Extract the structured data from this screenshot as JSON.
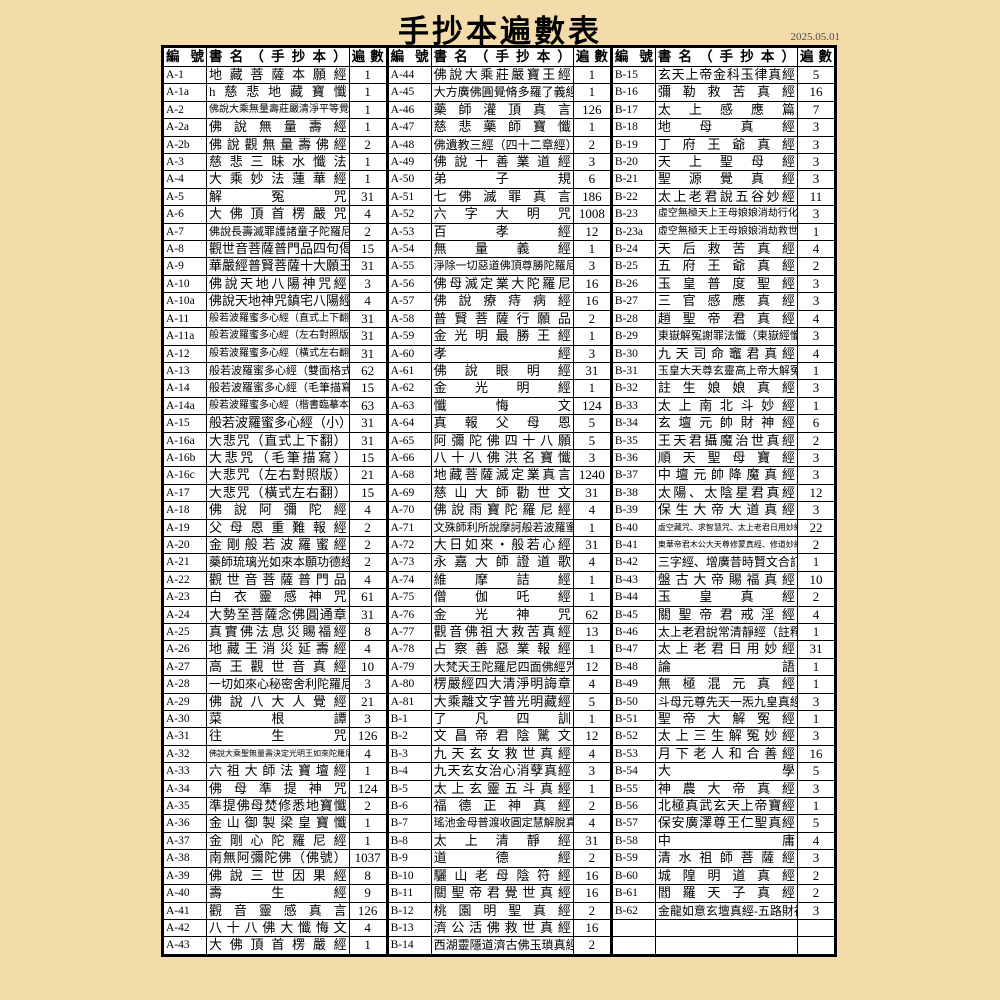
{
  "page": {
    "title": "手抄本遍數表",
    "date": "2025.05.01",
    "bg_color": "#f3dcaa",
    "table_bg_color": "#ffffff",
    "border_color": "#000000"
  },
  "table": {
    "header": {
      "id": "編號",
      "name": "書名（手抄本）",
      "count": "遍數"
    },
    "columns": [
      {
        "rows": [
          {
            "id": "A-1",
            "name": "地藏菩薩本願經",
            "count": "1"
          },
          {
            "id": "A-1a",
            "name": "h慈悲地藏寶懺",
            "count": "1"
          },
          {
            "id": "A-2",
            "name": "佛說大乘無量壽莊嚴清淨平等覺經",
            "count": "1"
          },
          {
            "id": "A-2a",
            "name": "佛說無量壽經",
            "count": "1"
          },
          {
            "id": "A-2b",
            "name": "佛說觀無量壽佛經",
            "count": "2"
          },
          {
            "id": "A-3",
            "name": "慈悲三昧水懺法",
            "count": "1"
          },
          {
            "id": "A-4",
            "name": "大乘妙法蓮華經",
            "count": "1"
          },
          {
            "id": "A-5",
            "name": "解冤咒",
            "count": "31"
          },
          {
            "id": "A-6",
            "name": "大佛頂首楞嚴咒",
            "count": "4"
          },
          {
            "id": "A-7",
            "name": "佛說長壽滅罪護諸童子陀羅尼經",
            "count": "2"
          },
          {
            "id": "A-8",
            "name": "觀世音菩薩普門品四句偈",
            "count": "15"
          },
          {
            "id": "A-9",
            "name": "華嚴經普賢菩薩十大願王",
            "count": "31"
          },
          {
            "id": "A-10",
            "name": "佛說天地八陽神咒經",
            "count": "3"
          },
          {
            "id": "A-10a",
            "name": "佛說天地神咒鎮宅八陽經",
            "count": "4"
          },
          {
            "id": "A-11",
            "name": "般若波羅蜜多心經（直式上下翻）",
            "count": "31"
          },
          {
            "id": "A-11a",
            "name": "般若波羅蜜多心經（左右對照版）",
            "count": "31"
          },
          {
            "id": "A-12",
            "name": "般若波羅蜜多心經（橫式左右翻）",
            "count": "31"
          },
          {
            "id": "A-13",
            "name": "般若波羅蜜多心經（雙面格式）",
            "count": "62"
          },
          {
            "id": "A-14",
            "name": "般若波羅蜜多心經（毛筆描寫）",
            "count": "15"
          },
          {
            "id": "A-14a",
            "name": "般若波羅蜜多心經（楷書臨摹本）",
            "count": "63"
          },
          {
            "id": "A-15",
            "name": "般若波羅蜜多心經（小）",
            "count": "31"
          },
          {
            "id": "A-16a",
            "name": "大悲咒（直式上下翻）",
            "count": "31"
          },
          {
            "id": "A-16b",
            "name": "大悲咒（毛筆描寫）",
            "count": "15"
          },
          {
            "id": "A-16c",
            "name": "大悲咒（左右對照版）",
            "count": "21"
          },
          {
            "id": "A-17",
            "name": "大悲咒（橫式左右翻）",
            "count": "15"
          },
          {
            "id": "A-18",
            "name": "佛說阿彌陀經",
            "count": "4"
          },
          {
            "id": "A-19",
            "name": "父母恩重難報經",
            "count": "2"
          },
          {
            "id": "A-20",
            "name": "金剛般若波羅蜜經",
            "count": "2"
          },
          {
            "id": "A-21",
            "name": "藥師琉璃光如來本願功德經",
            "count": "2"
          },
          {
            "id": "A-22",
            "name": "觀世音菩薩普門品",
            "count": "4"
          },
          {
            "id": "A-23",
            "name": "白衣靈感神咒",
            "count": "61"
          },
          {
            "id": "A-24",
            "name": "大勢至菩薩念佛圓通章",
            "count": "31"
          },
          {
            "id": "A-25",
            "name": "真實佛法息災賜福經",
            "count": "8"
          },
          {
            "id": "A-26",
            "name": "地藏王消災延壽經",
            "count": "4"
          },
          {
            "id": "A-27",
            "name": "高王觀世音真經",
            "count": "10"
          },
          {
            "id": "A-28",
            "name": "一切如來心秘密舍利陀羅尼經",
            "count": "3"
          },
          {
            "id": "A-29",
            "name": "佛說八大人覺經",
            "count": "21"
          },
          {
            "id": "A-30",
            "name": "菜根譚",
            "count": "3"
          },
          {
            "id": "A-31",
            "name": "往生咒",
            "count": "126"
          },
          {
            "id": "A-32",
            "name": "佛說大乘聖無量壽決定光明王如來陀羅尼經",
            "count": "4"
          },
          {
            "id": "A-33",
            "name": "六祖大師法寶壇經",
            "count": "1"
          },
          {
            "id": "A-34",
            "name": "佛母準提神咒",
            "count": "124"
          },
          {
            "id": "A-35",
            "name": "準提佛母焚修悉地寶懺",
            "count": "2"
          },
          {
            "id": "A-36",
            "name": "金山御製梁皇寶懺",
            "count": "1"
          },
          {
            "id": "A-37",
            "name": "金剛心陀羅尼經",
            "count": "1"
          },
          {
            "id": "A-38",
            "name": "南無阿彌陀佛（佛號）",
            "count": "1037"
          },
          {
            "id": "A-39",
            "name": "佛說三世因果經",
            "count": "8"
          },
          {
            "id": "A-40",
            "name": "壽生經",
            "count": "9"
          },
          {
            "id": "A-41",
            "name": "觀音靈感真言",
            "count": "126"
          },
          {
            "id": "A-42",
            "name": "八十八佛大懺悔文",
            "count": "4"
          },
          {
            "id": "A-43",
            "name": "大佛頂首楞嚴經",
            "count": "1"
          }
        ]
      },
      {
        "rows": [
          {
            "id": "A-44",
            "name": "佛說大乘莊嚴寶王經",
            "count": "1"
          },
          {
            "id": "A-45",
            "name": "大方廣佛圓覺脩多羅了義經",
            "count": "1"
          },
          {
            "id": "A-46",
            "name": "藥師灌頂真言",
            "count": "126"
          },
          {
            "id": "A-47",
            "name": "慈悲藥師寶懺",
            "count": "1"
          },
          {
            "id": "A-48",
            "name": "佛遺教三經（四十二章經）",
            "count": "2"
          },
          {
            "id": "A-49",
            "name": "佛說十善業道經",
            "count": "3"
          },
          {
            "id": "A-50",
            "name": "弟子規",
            "count": "6"
          },
          {
            "id": "A-51",
            "name": "七佛滅罪真言",
            "count": "186"
          },
          {
            "id": "A-52",
            "name": "六字大明咒",
            "count": "1008"
          },
          {
            "id": "A-53",
            "name": "百孝經",
            "count": "12"
          },
          {
            "id": "A-54",
            "name": "無量義經",
            "count": "1"
          },
          {
            "id": "A-55",
            "name": "淨除一切惡道佛頂尊勝陀羅尼經",
            "count": "3"
          },
          {
            "id": "A-56",
            "name": "佛母滅定業大陀羅尼",
            "count": "16"
          },
          {
            "id": "A-57",
            "name": "佛說療痔病經",
            "count": "16"
          },
          {
            "id": "A-58",
            "name": "普賢菩薩行願品",
            "count": "2"
          },
          {
            "id": "A-59",
            "name": "金光明最勝王經",
            "count": "1"
          },
          {
            "id": "A-60",
            "name": "孝經",
            "count": "3"
          },
          {
            "id": "A-61",
            "name": "佛說眼明經",
            "count": "31"
          },
          {
            "id": "A-62",
            "name": "金光明經",
            "count": "1"
          },
          {
            "id": "A-63",
            "name": "懺悔文",
            "count": "124"
          },
          {
            "id": "A-64",
            "name": "真報父母恩",
            "count": "5"
          },
          {
            "id": "A-65",
            "name": "阿彌陀佛四十八願",
            "count": "5"
          },
          {
            "id": "A-66",
            "name": "八十八佛洪名寶懺",
            "count": "3"
          },
          {
            "id": "A-68",
            "name": "地藏菩薩滅定業真言",
            "count": "1240"
          },
          {
            "id": "A-69",
            "name": "慈山大師勸世文",
            "count": "31"
          },
          {
            "id": "A-70",
            "name": "佛說雨寶陀羅尼經",
            "count": "4"
          },
          {
            "id": "A-71",
            "name": "文殊師利所說摩訶般若波羅蜜經",
            "count": "1"
          },
          {
            "id": "A-72",
            "name": "大日如來・般若心經",
            "count": "31"
          },
          {
            "id": "A-73",
            "name": "永嘉大師證道歌",
            "count": "4"
          },
          {
            "id": "A-74",
            "name": "維摩詰經",
            "count": "1"
          },
          {
            "id": "A-75",
            "name": "僧伽吒經",
            "count": "1"
          },
          {
            "id": "A-76",
            "name": "金光神咒",
            "count": "62"
          },
          {
            "id": "A-77",
            "name": "觀音佛祖大救苦真經",
            "count": "13"
          },
          {
            "id": "A-78",
            "name": "占察善惡業報經",
            "count": "1"
          },
          {
            "id": "A-79",
            "name": "大梵天王陀羅尼四面佛經咒",
            "count": "12"
          },
          {
            "id": "A-80",
            "name": "楞嚴經四大清淨明誨章",
            "count": "4"
          },
          {
            "id": "A-81",
            "name": "大乘離文字普光明藏經",
            "count": "5"
          },
          {
            "id": "B-1",
            "name": "了凡四訓",
            "count": "1"
          },
          {
            "id": "B-2",
            "name": "文昌帝君陰騭文",
            "count": "12"
          },
          {
            "id": "B-3",
            "name": "九天玄女救世真經",
            "count": "4"
          },
          {
            "id": "B-4",
            "name": "九天玄女治心消孽真經",
            "count": "3"
          },
          {
            "id": "B-5",
            "name": "太上玄靈五斗真經",
            "count": "1"
          },
          {
            "id": "B-6",
            "name": "福德正神真經",
            "count": "2"
          },
          {
            "id": "B-7",
            "name": "瑤池金母普渡收圓定慧解脫真經",
            "count": "4"
          },
          {
            "id": "B-8",
            "name": "太上清靜經",
            "count": "31"
          },
          {
            "id": "B-9",
            "name": "道德經",
            "count": "2"
          },
          {
            "id": "B-10",
            "name": "驪山老母陰符經",
            "count": "16"
          },
          {
            "id": "B-11",
            "name": "關聖帝君覺世真經",
            "count": "16"
          },
          {
            "id": "B-12",
            "name": "桃園明聖真經",
            "count": "2"
          },
          {
            "id": "B-13",
            "name": "濟公活佛救世真經",
            "count": "16"
          },
          {
            "id": "B-14",
            "name": "西湖靈隱道濟古佛玉瑣真經",
            "count": "2"
          }
        ]
      },
      {
        "rows": [
          {
            "id": "B-15",
            "name": "玄天上帝金科玉律真經",
            "count": "5"
          },
          {
            "id": "B-16",
            "name": "彌勒救苦真經",
            "count": "16"
          },
          {
            "id": "B-17",
            "name": "太上感應篇",
            "count": "7"
          },
          {
            "id": "B-18",
            "name": "地母真經",
            "count": "3"
          },
          {
            "id": "B-19",
            "name": "丁府王爺真經",
            "count": "3"
          },
          {
            "id": "B-20",
            "name": "天上聖母經",
            "count": "3"
          },
          {
            "id": "B-21",
            "name": "聖源覺真經",
            "count": "3"
          },
          {
            "id": "B-22",
            "name": "太上老君說五谷妙經",
            "count": "11"
          },
          {
            "id": "B-23",
            "name": "虛空無極天上王母娘娘消劫行化寶懺",
            "count": "3"
          },
          {
            "id": "B-23a",
            "name": "虛空無極天上王母娘娘消劫救世寶懺",
            "count": "1"
          },
          {
            "id": "B-24",
            "name": "天后救苦真經",
            "count": "4"
          },
          {
            "id": "B-25",
            "name": "五府王爺真經",
            "count": "2"
          },
          {
            "id": "B-26",
            "name": "玉皇普度聖經",
            "count": "3"
          },
          {
            "id": "B-27",
            "name": "三官感應真經",
            "count": "3"
          },
          {
            "id": "B-28",
            "name": "趙聖帝君真經",
            "count": "4"
          },
          {
            "id": "B-29",
            "name": "東嶽解冤謝罪法懺（東嶽經懺）",
            "count": "3"
          },
          {
            "id": "B-30",
            "name": "九天司命竈君真經",
            "count": "4"
          },
          {
            "id": "B-31",
            "name": "玉皇大天尊玄靈高上帝大解冤經",
            "count": "1"
          },
          {
            "id": "B-32",
            "name": "註生娘娘真經",
            "count": "3"
          },
          {
            "id": "B-33",
            "name": "太上南北斗妙經",
            "count": "1"
          },
          {
            "id": "B-34",
            "name": "玄壇元帥財神經",
            "count": "6"
          },
          {
            "id": "B-35",
            "name": "王天君攝魔治世真經",
            "count": "2"
          },
          {
            "id": "B-36",
            "name": "順天聖母寶經",
            "count": "3"
          },
          {
            "id": "B-37",
            "name": "中壇元帥降魔真經",
            "count": "3"
          },
          {
            "id": "B-38",
            "name": "太陽、太陰星君真經",
            "count": "12"
          },
          {
            "id": "B-39",
            "name": "保生大帝大道真經",
            "count": "3"
          },
          {
            "id": "B-40",
            "name": "虛空藏咒、求智慧咒、太上老君日用妙經",
            "count": "22"
          },
          {
            "id": "B-41",
            "name": "東華帝君木公大天尊修蒙真經、修道妙經",
            "count": "2"
          },
          {
            "id": "B-42",
            "name": "三字經、增廣昔時賢文合訂本",
            "count": "1"
          },
          {
            "id": "B-43",
            "name": "盤古大帝賜福真經",
            "count": "10"
          },
          {
            "id": "B-44",
            "name": "玉皇真經",
            "count": "2"
          },
          {
            "id": "B-45",
            "name": "關聖帝君戒淫經",
            "count": "4"
          },
          {
            "id": "B-46",
            "name": "太上老君說常清靜經（註釋）",
            "count": "1"
          },
          {
            "id": "B-47",
            "name": "太上老君日用妙經",
            "count": "31"
          },
          {
            "id": "B-48",
            "name": "論語",
            "count": "1"
          },
          {
            "id": "B-49",
            "name": "無極混元真經",
            "count": "1"
          },
          {
            "id": "B-50",
            "name": "斗母元尊先天一炁九皇真經",
            "count": "3"
          },
          {
            "id": "B-51",
            "name": "聖帝大解冤經",
            "count": "1"
          },
          {
            "id": "B-52",
            "name": "太上三生解冤妙經",
            "count": "3"
          },
          {
            "id": "B-53",
            "name": "月下老人和合善經",
            "count": "16"
          },
          {
            "id": "B-54",
            "name": "大學",
            "count": "5"
          },
          {
            "id": "B-55",
            "name": "神農大帝真經",
            "count": "3"
          },
          {
            "id": "B-56",
            "name": "北極真武玄天上帝寶經",
            "count": "1"
          },
          {
            "id": "B-57",
            "name": "保安廣澤尊王仁聖真經",
            "count": "5"
          },
          {
            "id": "B-58",
            "name": "中庸",
            "count": "4"
          },
          {
            "id": "B-59",
            "name": "清水祖師菩薩經",
            "count": "3"
          },
          {
            "id": "B-60",
            "name": "城隍明道真經",
            "count": "2"
          },
          {
            "id": "B-61",
            "name": "閻羅天子真經",
            "count": "2"
          },
          {
            "id": "B-62",
            "name": "金龍如意玄壇真經-五路財神",
            "count": "3"
          },
          {
            "id": "",
            "name": "",
            "count": ""
          },
          {
            "id": "",
            "name": "",
            "count": ""
          }
        ]
      }
    ]
  }
}
